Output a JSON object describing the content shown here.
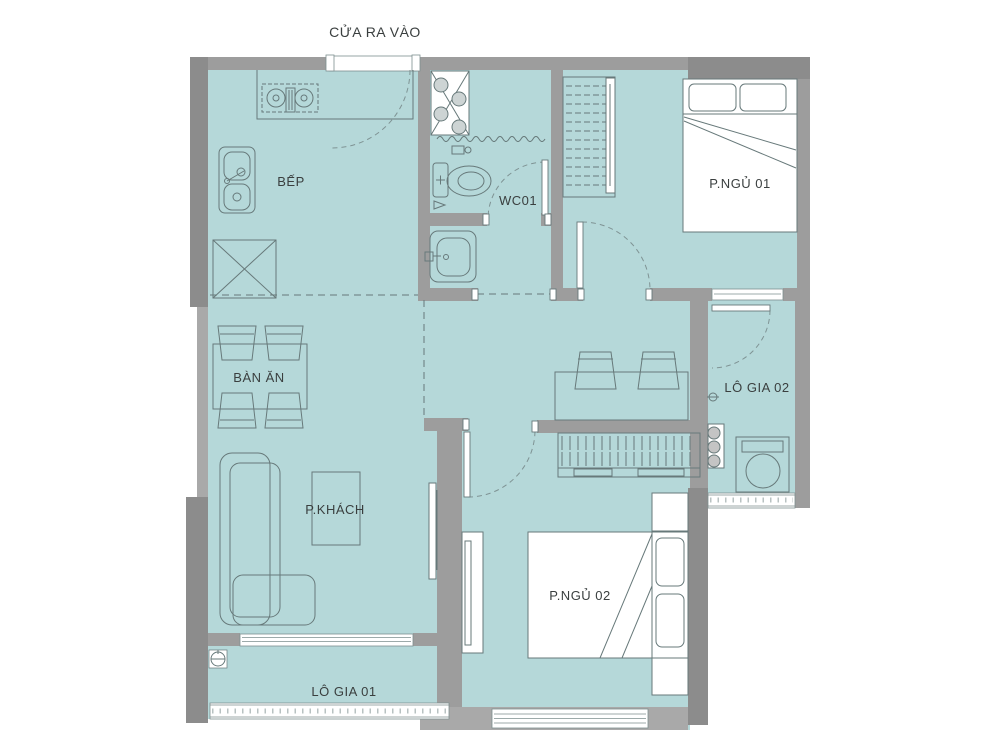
{
  "plan": {
    "entrance_label": "CỬA RA VÀO",
    "rooms": [
      {
        "id": "kitchen",
        "label": "BẾP"
      },
      {
        "id": "wc",
        "label": "WC01"
      },
      {
        "id": "bedroom-1",
        "label": "P.NGỦ 01"
      },
      {
        "id": "loggia-2",
        "label": "LÔ GIA 02"
      },
      {
        "id": "dining",
        "label": "BÀN ĂN"
      },
      {
        "id": "living",
        "label": "P.KHÁCH"
      },
      {
        "id": "bedroom-2",
        "label": "P.NGỦ 02"
      },
      {
        "id": "loggia-1",
        "label": "LÔ GIA 01"
      }
    ],
    "colors": {
      "floor": "#b5d8d9",
      "wall": "#9d9d9d",
      "wall_dark": "#8c8c8c",
      "wall_light": "#a9a9a9",
      "line": "#67797a",
      "window": "#ffffff",
      "text": "#3a3f3f"
    }
  }
}
